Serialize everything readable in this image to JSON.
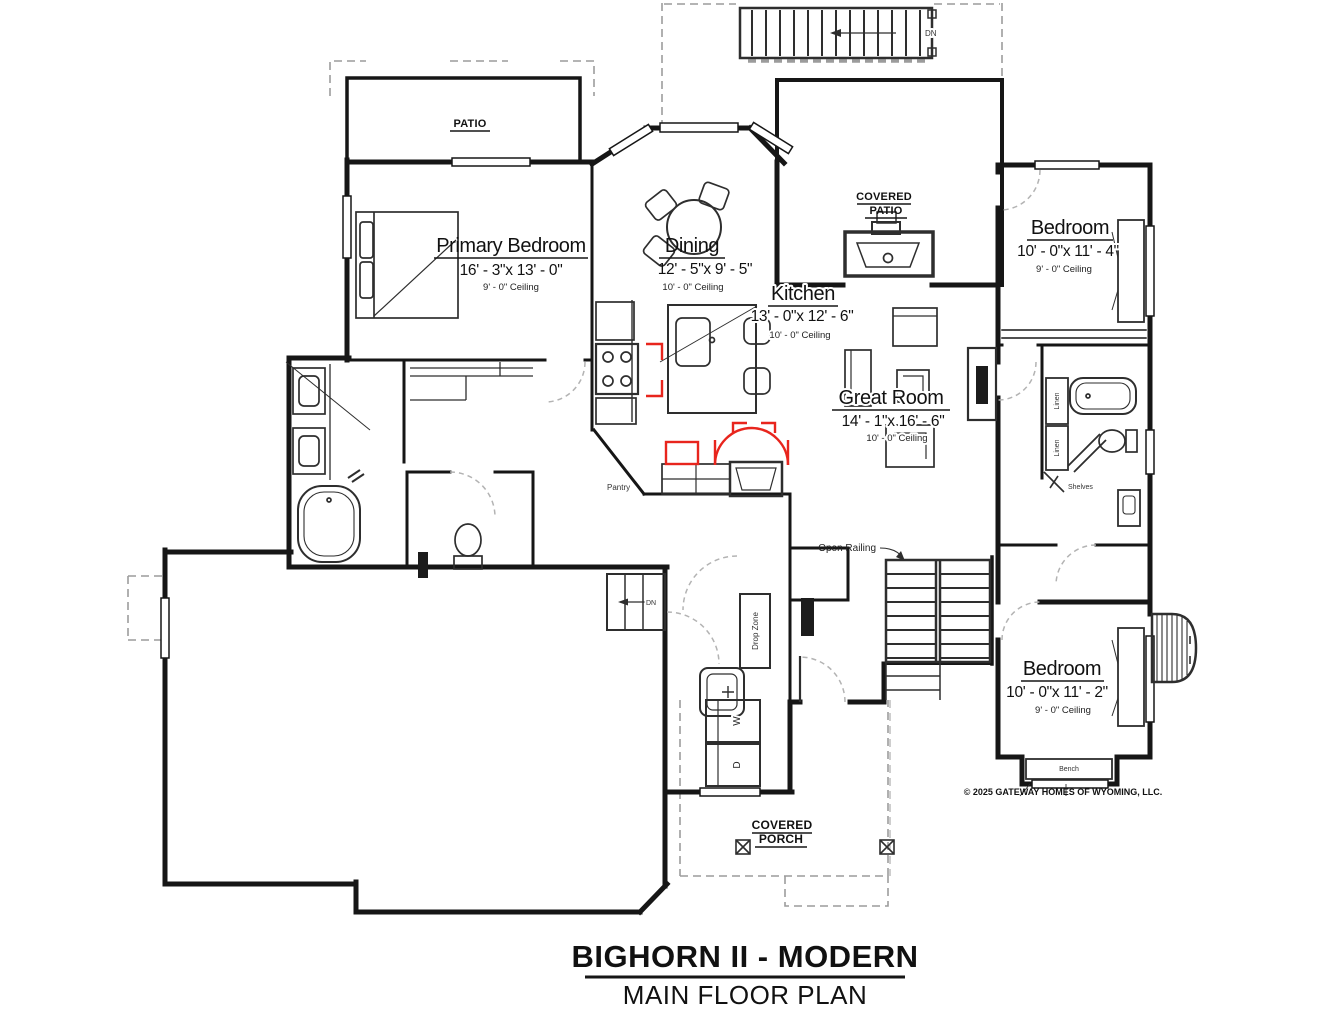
{
  "title": {
    "name": "BIGHORN II - MODERN",
    "plan": "MAIN FLOOR PLAN"
  },
  "copyright": "© 2025 GATEWAY HOMES OF WYOMING, LLC.",
  "rooms": {
    "primary_bedroom": {
      "name": "Primary Bedroom",
      "dims": "16' - 3\"x 13' - 0\"",
      "ceiling": "9' - 0\" Ceiling"
    },
    "dining": {
      "name": "Dining",
      "dims": "12' - 5\"x 9' - 5\"",
      "ceiling": "10' - 0\" Ceiling"
    },
    "kitchen": {
      "name": "Kitchen",
      "dims": "13' - 0\"x 12' - 6\"",
      "ceiling": "10' - 0\" Ceiling"
    },
    "great_room": {
      "name": "Great Room",
      "dims": "14' - 1\"x 16' - 6\"",
      "ceiling": "10' - 0\" Ceiling"
    },
    "bedroom_upper": {
      "name": "Bedroom",
      "dims": "10' - 0\"x 11' - 4\"",
      "ceiling": "9' - 0\" Ceiling"
    },
    "bedroom_lower": {
      "name": "Bedroom",
      "dims": "10' - 0\"x 11' - 2\"",
      "ceiling": "9' - 0\" Ceiling"
    }
  },
  "outdoor": {
    "patio": "PATIO",
    "covered_patio_line1": "COVERED",
    "covered_patio_line2": "PATIO",
    "covered_porch_line1": "COVERED",
    "covered_porch_line2": "PORCH"
  },
  "labels": {
    "open_railing": "Open Railing",
    "pantry": "Pantry",
    "drop_zone": "Drop Zone",
    "linen_1": "Linen",
    "linen_2": "Linen",
    "shelves": "Shelves",
    "bench": "Bench",
    "dn_top_stairs": "DN",
    "dn_garage_steps": "DN",
    "washer": "W",
    "dryer": "D"
  },
  "colors": {
    "wall": "#161616",
    "fixture": "#2e2e2e",
    "accent_red": "#e8251d",
    "overhang": "#9c9c9c",
    "door_arc": "#b3b3b3"
  }
}
